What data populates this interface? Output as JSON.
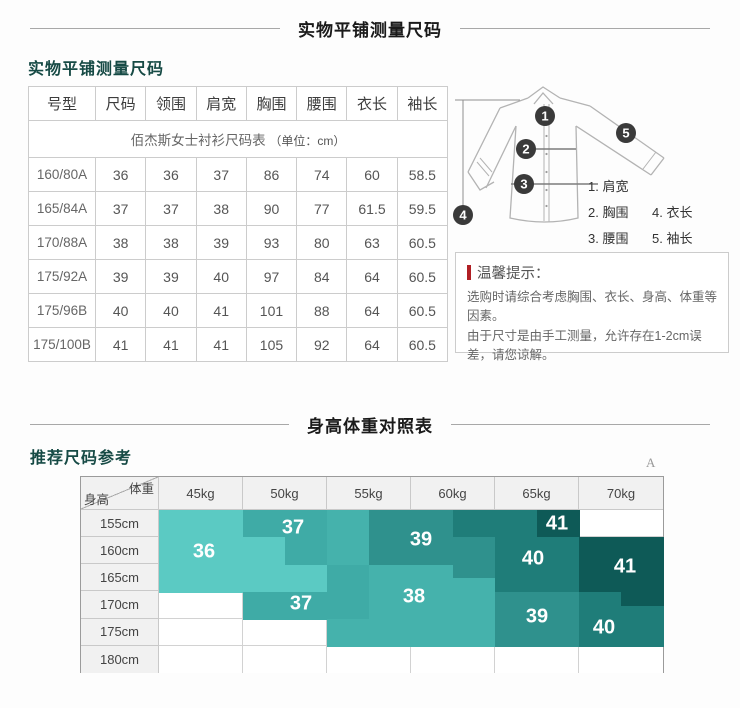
{
  "page": {
    "top_divider": "实物平铺测量尺码",
    "section1_heading": "实物平铺测量尺码",
    "bottom_divider": "身高体重对照表",
    "section2_heading": "推荐尺码参考",
    "corner_mark": "A"
  },
  "size_table": {
    "title": "佰杰斯女士衬衫尺码表",
    "unit": "（单位：cm）",
    "headers": [
      "号型",
      "尺码",
      "领围",
      "肩宽",
      "胸围",
      "腰围",
      "衣长",
      "袖长"
    ],
    "rows": [
      [
        "160/80A",
        "36",
        "36",
        "37",
        "86",
        "74",
        "60",
        "58.5"
      ],
      [
        "165/84A",
        "37",
        "37",
        "38",
        "90",
        "77",
        "61.5",
        "59.5"
      ],
      [
        "170/88A",
        "38",
        "38",
        "39",
        "93",
        "80",
        "63",
        "60.5"
      ],
      [
        "175/92A",
        "39",
        "39",
        "40",
        "97",
        "84",
        "64",
        "60.5"
      ],
      [
        "175/96B",
        "40",
        "40",
        "41",
        "101",
        "88",
        "64",
        "60.5"
      ],
      [
        "175/100B",
        "41",
        "41",
        "41",
        "105",
        "92",
        "64",
        "60.5"
      ]
    ]
  },
  "diagram": {
    "badges": [
      "1",
      "2",
      "3",
      "4",
      "5"
    ],
    "legend": [
      "1. 肩宽",
      "2. 胸围",
      "4. 衣长",
      "3. 腰围",
      "5. 袖长"
    ]
  },
  "tips": {
    "title": "温馨提示：",
    "lines": [
      "选购时请综合考虑胸围、衣长、身高、体重等因素。",
      "由于尺寸是由手工测量，允许存在1-2cm误差，请您谅解。"
    ]
  },
  "chart_data": {
    "type": "heatmap",
    "title": "推荐尺码参考",
    "xlabel": "体重",
    "ylabel": "身高",
    "corner": {
      "top": "体重",
      "bottom": "身高"
    },
    "x_categories": [
      "45kg",
      "50kg",
      "55kg",
      "60kg",
      "65kg",
      "70kg"
    ],
    "y_categories": [
      "155cm",
      "160cm",
      "165cm",
      "170cm",
      "175cm",
      "180cm"
    ],
    "palette": {
      "36": "#5bcac3",
      "37": "#3faba6",
      "38": "#45b2ac",
      "39": "#2f918d",
      "40": "#1f7d79",
      "41": "#0e5a57"
    },
    "half_cell_grid": [
      [
        "36",
        "36",
        "37",
        "37",
        "38",
        "39",
        "39",
        "40",
        "40",
        "41",
        "W",
        "W"
      ],
      [
        "36",
        "36",
        "37",
        "37",
        "38",
        "39",
        "39",
        "40",
        "40",
        "41",
        "W",
        "W"
      ],
      [
        "36",
        "36",
        "36",
        "37",
        "38",
        "39",
        "39",
        "39",
        "40",
        "40",
        "41",
        "41"
      ],
      [
        "36",
        "36",
        "36",
        "37",
        "38",
        "39",
        "39",
        "39",
        "40",
        "40",
        "41",
        "41"
      ],
      [
        "36",
        "36",
        "36",
        "36",
        "37",
        "38",
        "38",
        "39",
        "40",
        "40",
        "41",
        "41"
      ],
      [
        "36",
        "36",
        "36",
        "36",
        "37",
        "38",
        "38",
        "38",
        "40",
        "40",
        "41",
        "41"
      ],
      [
        "W",
        "W",
        "37",
        "37",
        "37",
        "38",
        "38",
        "38",
        "39",
        "39",
        "40",
        "41"
      ],
      [
        "W",
        "W",
        "37",
        "37",
        "37",
        "38",
        "38",
        "38",
        "39",
        "39",
        "40",
        "40"
      ],
      [
        "W",
        "W",
        "W",
        "W",
        "38",
        "38",
        "38",
        "38",
        "39",
        "39",
        "40",
        "40"
      ],
      [
        "W",
        "W",
        "W",
        "W",
        "38",
        "38",
        "38",
        "38",
        "39",
        "39",
        "40",
        "40"
      ],
      [
        "W",
        "W",
        "W",
        "W",
        "W",
        "W",
        "W",
        "W",
        "W",
        "W",
        "W",
        "W"
      ],
      [
        "W",
        "W",
        "W",
        "W",
        "W",
        "W",
        "W",
        "W",
        "W",
        "W",
        "W",
        "W"
      ]
    ],
    "labels": [
      {
        "text": "36",
        "x": 45,
        "y": 42
      },
      {
        "text": "37",
        "x": 134,
        "y": 18
      },
      {
        "text": "39",
        "x": 262,
        "y": 30
      },
      {
        "text": "41",
        "x": 398,
        "y": 14
      },
      {
        "text": "40",
        "x": 374,
        "y": 49
      },
      {
        "text": "41",
        "x": 466,
        "y": 57
      },
      {
        "text": "37",
        "x": 142,
        "y": 94
      },
      {
        "text": "38",
        "x": 255,
        "y": 87
      },
      {
        "text": "39",
        "x": 378,
        "y": 107
      },
      {
        "text": "40",
        "x": 445,
        "y": 118
      }
    ]
  }
}
